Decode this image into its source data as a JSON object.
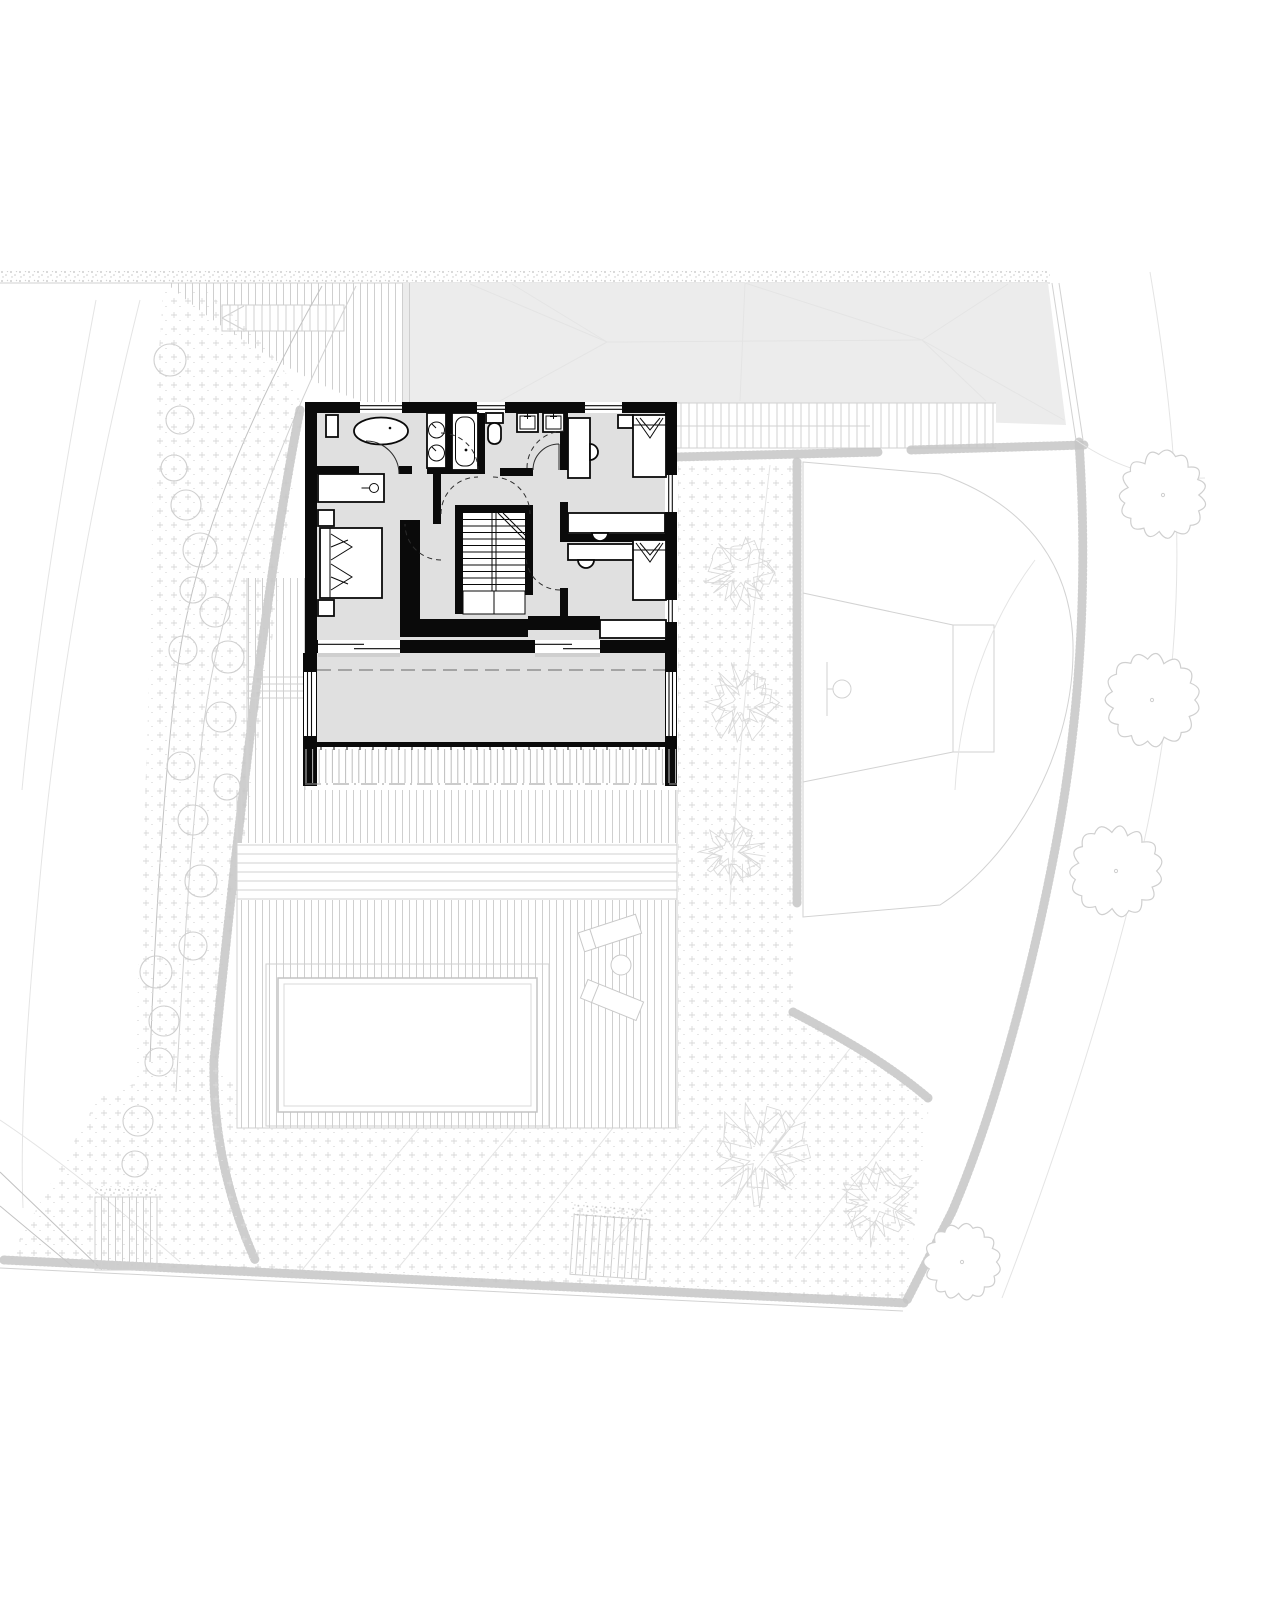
{
  "document": {
    "kind": "architectural-plan",
    "view": "upper-floor plan with garden site context",
    "visible_text": [],
    "canvas": {
      "width": 1280,
      "height": 1600
    }
  },
  "colors": {
    "paper": "#ffffff",
    "wall": "#0a0a0a",
    "floor_fill": "#e0e0e0",
    "roof_fill": "#ececec",
    "site_line": "#d2d2d2",
    "site_line_faint": "#e4e4e4",
    "site_line_strong": "#c2c2c2",
    "stipple": "#c6c6c6",
    "hatch": "#cfcfcf",
    "plus_pattern": "#d9d9d9",
    "tree": "#cfcfcf",
    "bush": "#dadada",
    "dash_line": "#8f8f8f"
  },
  "site": {
    "road_band": {
      "x": 0,
      "y": 271,
      "w": 1050,
      "h": 11
    },
    "neighbor_roof": {
      "points": "403,283 1048,283 1066,425 403,403"
    },
    "driveway": {
      "x": 166,
      "y": 283,
      "w": 248,
      "h": 120,
      "pattern": "vertical-hatch"
    },
    "trees": [
      {
        "cx": 1163,
        "cy": 495,
        "r": 38
      },
      {
        "cx": 1152,
        "cy": 700,
        "r": 41
      },
      {
        "cx": 1116,
        "cy": 871,
        "r": 40
      },
      {
        "cx": 962,
        "cy": 1262,
        "r": 33
      }
    ],
    "bushes": [
      {
        "cx": 741,
        "cy": 572,
        "r": 34
      },
      {
        "cx": 742,
        "cy": 702,
        "r": 37
      },
      {
        "cx": 731,
        "cy": 852,
        "r": 32
      },
      {
        "cx": 760,
        "cy": 1157,
        "r": 50
      },
      {
        "cx": 876,
        "cy": 1203,
        "r": 40
      }
    ],
    "shrub_circles": [
      {
        "cx": 170,
        "cy": 360,
        "r": 16
      },
      {
        "cx": 180,
        "cy": 420,
        "r": 14
      },
      {
        "cx": 174,
        "cy": 468,
        "r": 13
      },
      {
        "cx": 186,
        "cy": 505,
        "r": 15
      },
      {
        "cx": 200,
        "cy": 550,
        "r": 17
      },
      {
        "cx": 193,
        "cy": 590,
        "r": 13
      },
      {
        "cx": 215,
        "cy": 612,
        "r": 15
      },
      {
        "cx": 183,
        "cy": 650,
        "r": 14
      },
      {
        "cx": 228,
        "cy": 657,
        "r": 16
      },
      {
        "cx": 221,
        "cy": 717,
        "r": 15
      },
      {
        "cx": 181,
        "cy": 766,
        "r": 14
      },
      {
        "cx": 227,
        "cy": 787,
        "r": 13
      },
      {
        "cx": 193,
        "cy": 820,
        "r": 15
      },
      {
        "cx": 201,
        "cy": 881,
        "r": 16
      },
      {
        "cx": 193,
        "cy": 946,
        "r": 14
      },
      {
        "cx": 156,
        "cy": 972,
        "r": 16
      },
      {
        "cx": 164,
        "cy": 1021,
        "r": 15
      },
      {
        "cx": 159,
        "cy": 1062,
        "r": 14
      },
      {
        "cx": 138,
        "cy": 1121,
        "r": 15
      },
      {
        "cx": 135,
        "cy": 1164,
        "r": 13
      }
    ],
    "pool": {
      "x": 278,
      "y": 978,
      "w": 259,
      "h": 134
    },
    "deck": {
      "pattern": "vertical-hatch",
      "steps_band": {
        "y1": 843,
        "y2": 900
      }
    },
    "basketball_court": {
      "hoop": {
        "cx": 842,
        "cy": 689,
        "r": 9
      },
      "key_rect": {
        "x": 953,
        "y": 625,
        "w": 41,
        "h": 127
      }
    },
    "loungers": {
      "count": 2,
      "table": {
        "cx": 621,
        "cy": 965,
        "r": 10
      }
    }
  },
  "plan": {
    "outer_walls": {
      "x1": 305,
      "y1": 402,
      "x2": 677,
      "y2": 653
    },
    "balcony": {
      "x": 303,
      "y": 653,
      "w": 374,
      "h": 92,
      "louver_band_h": 41
    },
    "windows_top": [
      [
        360,
        402
      ],
      [
        477,
        505
      ],
      [
        585,
        622
      ]
    ],
    "windows_right": [
      [
        475,
        512
      ],
      [
        600,
        622
      ]
    ],
    "sliding_doors_bottom": [
      [
        318,
        400
      ],
      [
        535,
        600
      ]
    ],
    "rooms_depicted": [
      "bathroom-with-freestanding-tub",
      "shower-bath",
      "wc",
      "kids-bathroom",
      "hall-landing",
      "stair",
      "master-bedroom",
      "bedroom-1",
      "bedroom-2",
      "balcony"
    ],
    "fixtures_depicted": [
      "freestanding-oval-tub",
      "double-round-washbasins",
      "built-in-bathtub",
      "toilet",
      "two-square-washbasins",
      "double-bed",
      "two-single-beds",
      "desks-with-chairs",
      "wardrobes",
      "sideboard",
      "u-shaped-stair"
    ]
  }
}
